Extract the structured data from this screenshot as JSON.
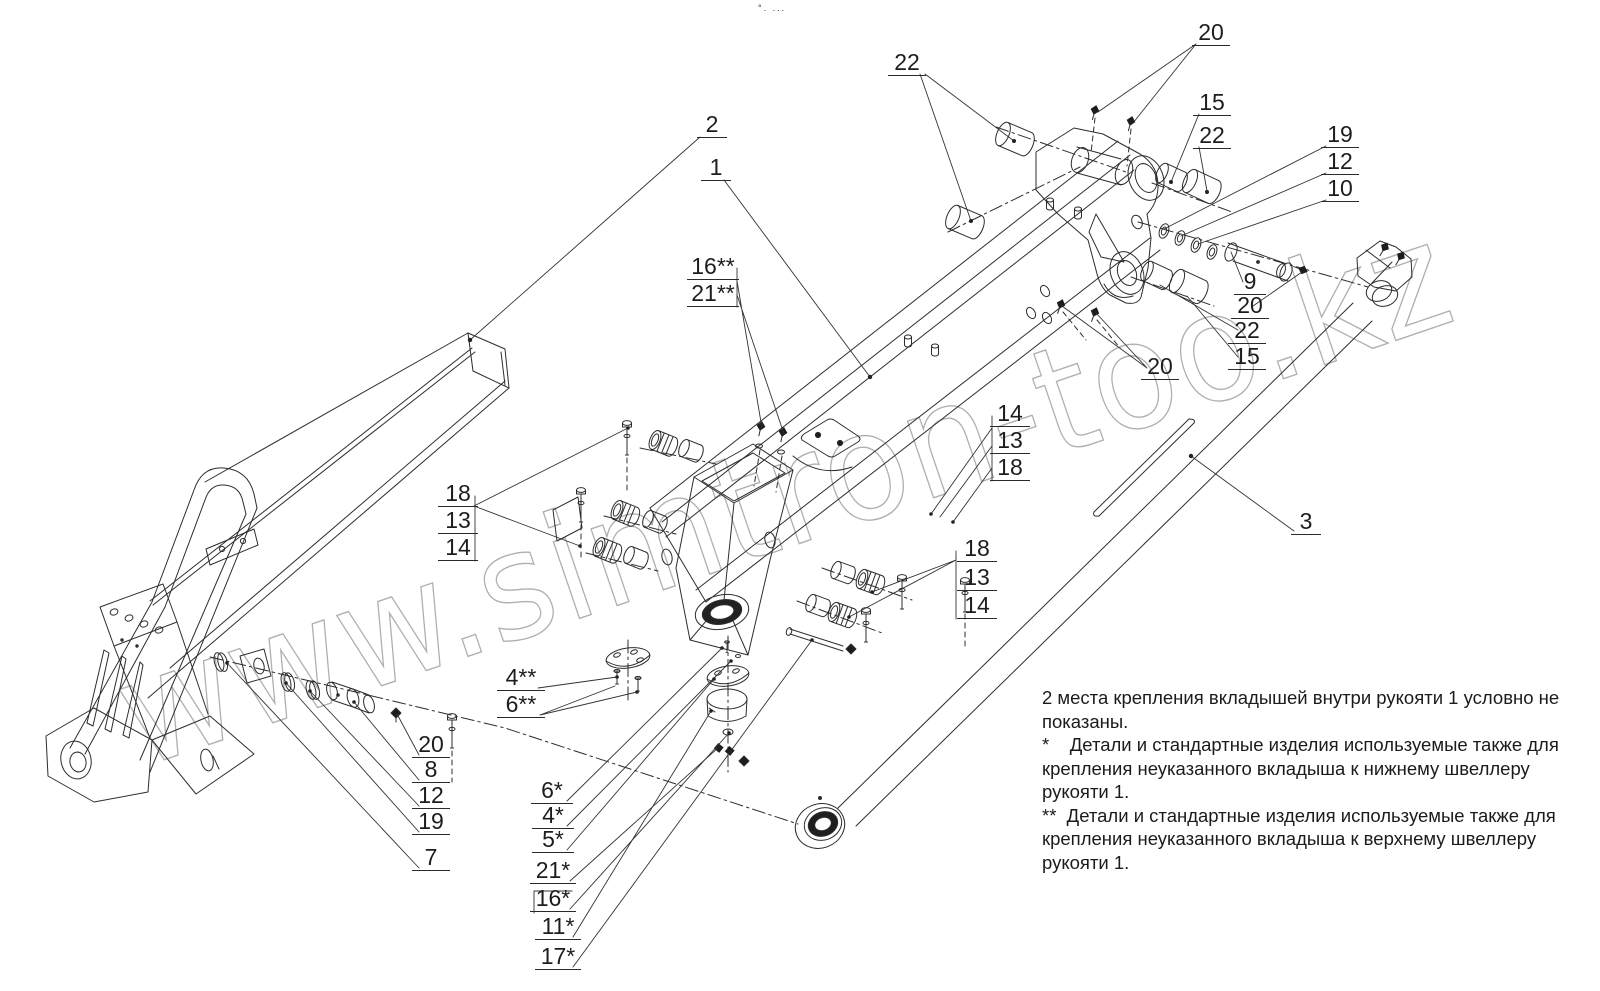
{
  "page": {
    "background": "#ffffff",
    "line_color": "#2d2d2d",
    "watermark_text": "www.simtron-too.kz",
    "watermark_color": "#b0b0b0",
    "top_marks": "°. ..."
  },
  "drawing": {
    "type": "exploded-view technical drawing",
    "subject": "crane handle / boom assembly with fastener hardware",
    "part_callouts_visible": [
      "1",
      "2",
      "3",
      "4*",
      "4**",
      "5*",
      "6*",
      "6**",
      "7",
      "8",
      "9",
      "10",
      "11*",
      "12",
      "13",
      "14",
      "15",
      "16*",
      "16**",
      "17*",
      "18",
      "19",
      "20",
      "21*",
      "21**",
      "22"
    ]
  },
  "callouts": [
    {
      "label": "22",
      "x": 907,
      "y": 76,
      "w": 34
    },
    {
      "label": "20",
      "x": 1211,
      "y": 46,
      "w": 34
    },
    {
      "label": "15",
      "x": 1212,
      "y": 116,
      "w": 34
    },
    {
      "label": "22",
      "x": 1212,
      "y": 149,
      "w": 34
    },
    {
      "label": "19",
      "x": 1340,
      "y": 148,
      "w": 34
    },
    {
      "label": "12",
      "x": 1340,
      "y": 175,
      "w": 34
    },
    {
      "label": "10",
      "x": 1340,
      "y": 202,
      "w": 34
    },
    {
      "label": "9",
      "x": 1250,
      "y": 295,
      "w": 28
    },
    {
      "label": "20",
      "x": 1250,
      "y": 319,
      "w": 34
    },
    {
      "label": "22",
      "x": 1247,
      "y": 344,
      "w": 34
    },
    {
      "label": "15",
      "x": 1247,
      "y": 370,
      "w": 34
    },
    {
      "label": "20",
      "x": 1160,
      "y": 380,
      "w": 34
    },
    {
      "label": "2",
      "x": 712,
      "y": 138,
      "w": 26
    },
    {
      "label": "1",
      "x": 716,
      "y": 181,
      "w": 26
    },
    {
      "label": "16**",
      "x": 713,
      "y": 280,
      "w": 48
    },
    {
      "label": "21**",
      "x": 713,
      "y": 307,
      "w": 48
    },
    {
      "label": "18",
      "x": 458,
      "y": 507,
      "w": 36
    },
    {
      "label": "13",
      "x": 458,
      "y": 534,
      "w": 36
    },
    {
      "label": "14",
      "x": 458,
      "y": 561,
      "w": 36
    },
    {
      "label": "14",
      "x": 1010,
      "y": 427,
      "w": 36
    },
    {
      "label": "13",
      "x": 1010,
      "y": 454,
      "w": 36
    },
    {
      "label": "18",
      "x": 1010,
      "y": 481,
      "w": 36
    },
    {
      "label": "18",
      "x": 977,
      "y": 562,
      "w": 36
    },
    {
      "label": "13",
      "x": 977,
      "y": 591,
      "w": 36
    },
    {
      "label": "14",
      "x": 977,
      "y": 619,
      "w": 36
    },
    {
      "label": "4**",
      "x": 521,
      "y": 691,
      "w": 44
    },
    {
      "label": "6**",
      "x": 521,
      "y": 718,
      "w": 44
    },
    {
      "label": "20",
      "x": 431,
      "y": 758,
      "w": 34
    },
    {
      "label": "8",
      "x": 431,
      "y": 783,
      "w": 34
    },
    {
      "label": "12",
      "x": 431,
      "y": 809,
      "w": 34
    },
    {
      "label": "19",
      "x": 431,
      "y": 835,
      "w": 34
    },
    {
      "label": "7",
      "x": 431,
      "y": 871,
      "w": 34
    },
    {
      "label": "6*",
      "x": 552,
      "y": 804,
      "w": 38
    },
    {
      "label": "4*",
      "x": 553,
      "y": 829,
      "w": 38
    },
    {
      "label": "5*",
      "x": 553,
      "y": 853,
      "w": 38
    },
    {
      "label": "21*",
      "x": 553,
      "y": 884,
      "w": 42
    },
    {
      "label": "16*",
      "x": 553,
      "y": 912,
      "w": 42
    },
    {
      "label": "11*",
      "x": 558,
      "y": 940,
      "w": 42
    },
    {
      "label": "17*",
      "x": 558,
      "y": 970,
      "w": 42
    },
    {
      "label": "3",
      "x": 1306,
      "y": 535,
      "w": 26
    }
  ],
  "notes": {
    "paragraphs": [
      "2 места крепления вкладышей внутри рукояти 1 условно не показаны.",
      "*    Детали и стандартные изделия используемые также для крепления неуказанного вкладыша к нижнему швеллеру рукояти 1.",
      "**  Детали и стандартные изделия используемые также для крепления неуказанного вкладыша к верхнему швеллеру рукояти 1."
    ]
  }
}
